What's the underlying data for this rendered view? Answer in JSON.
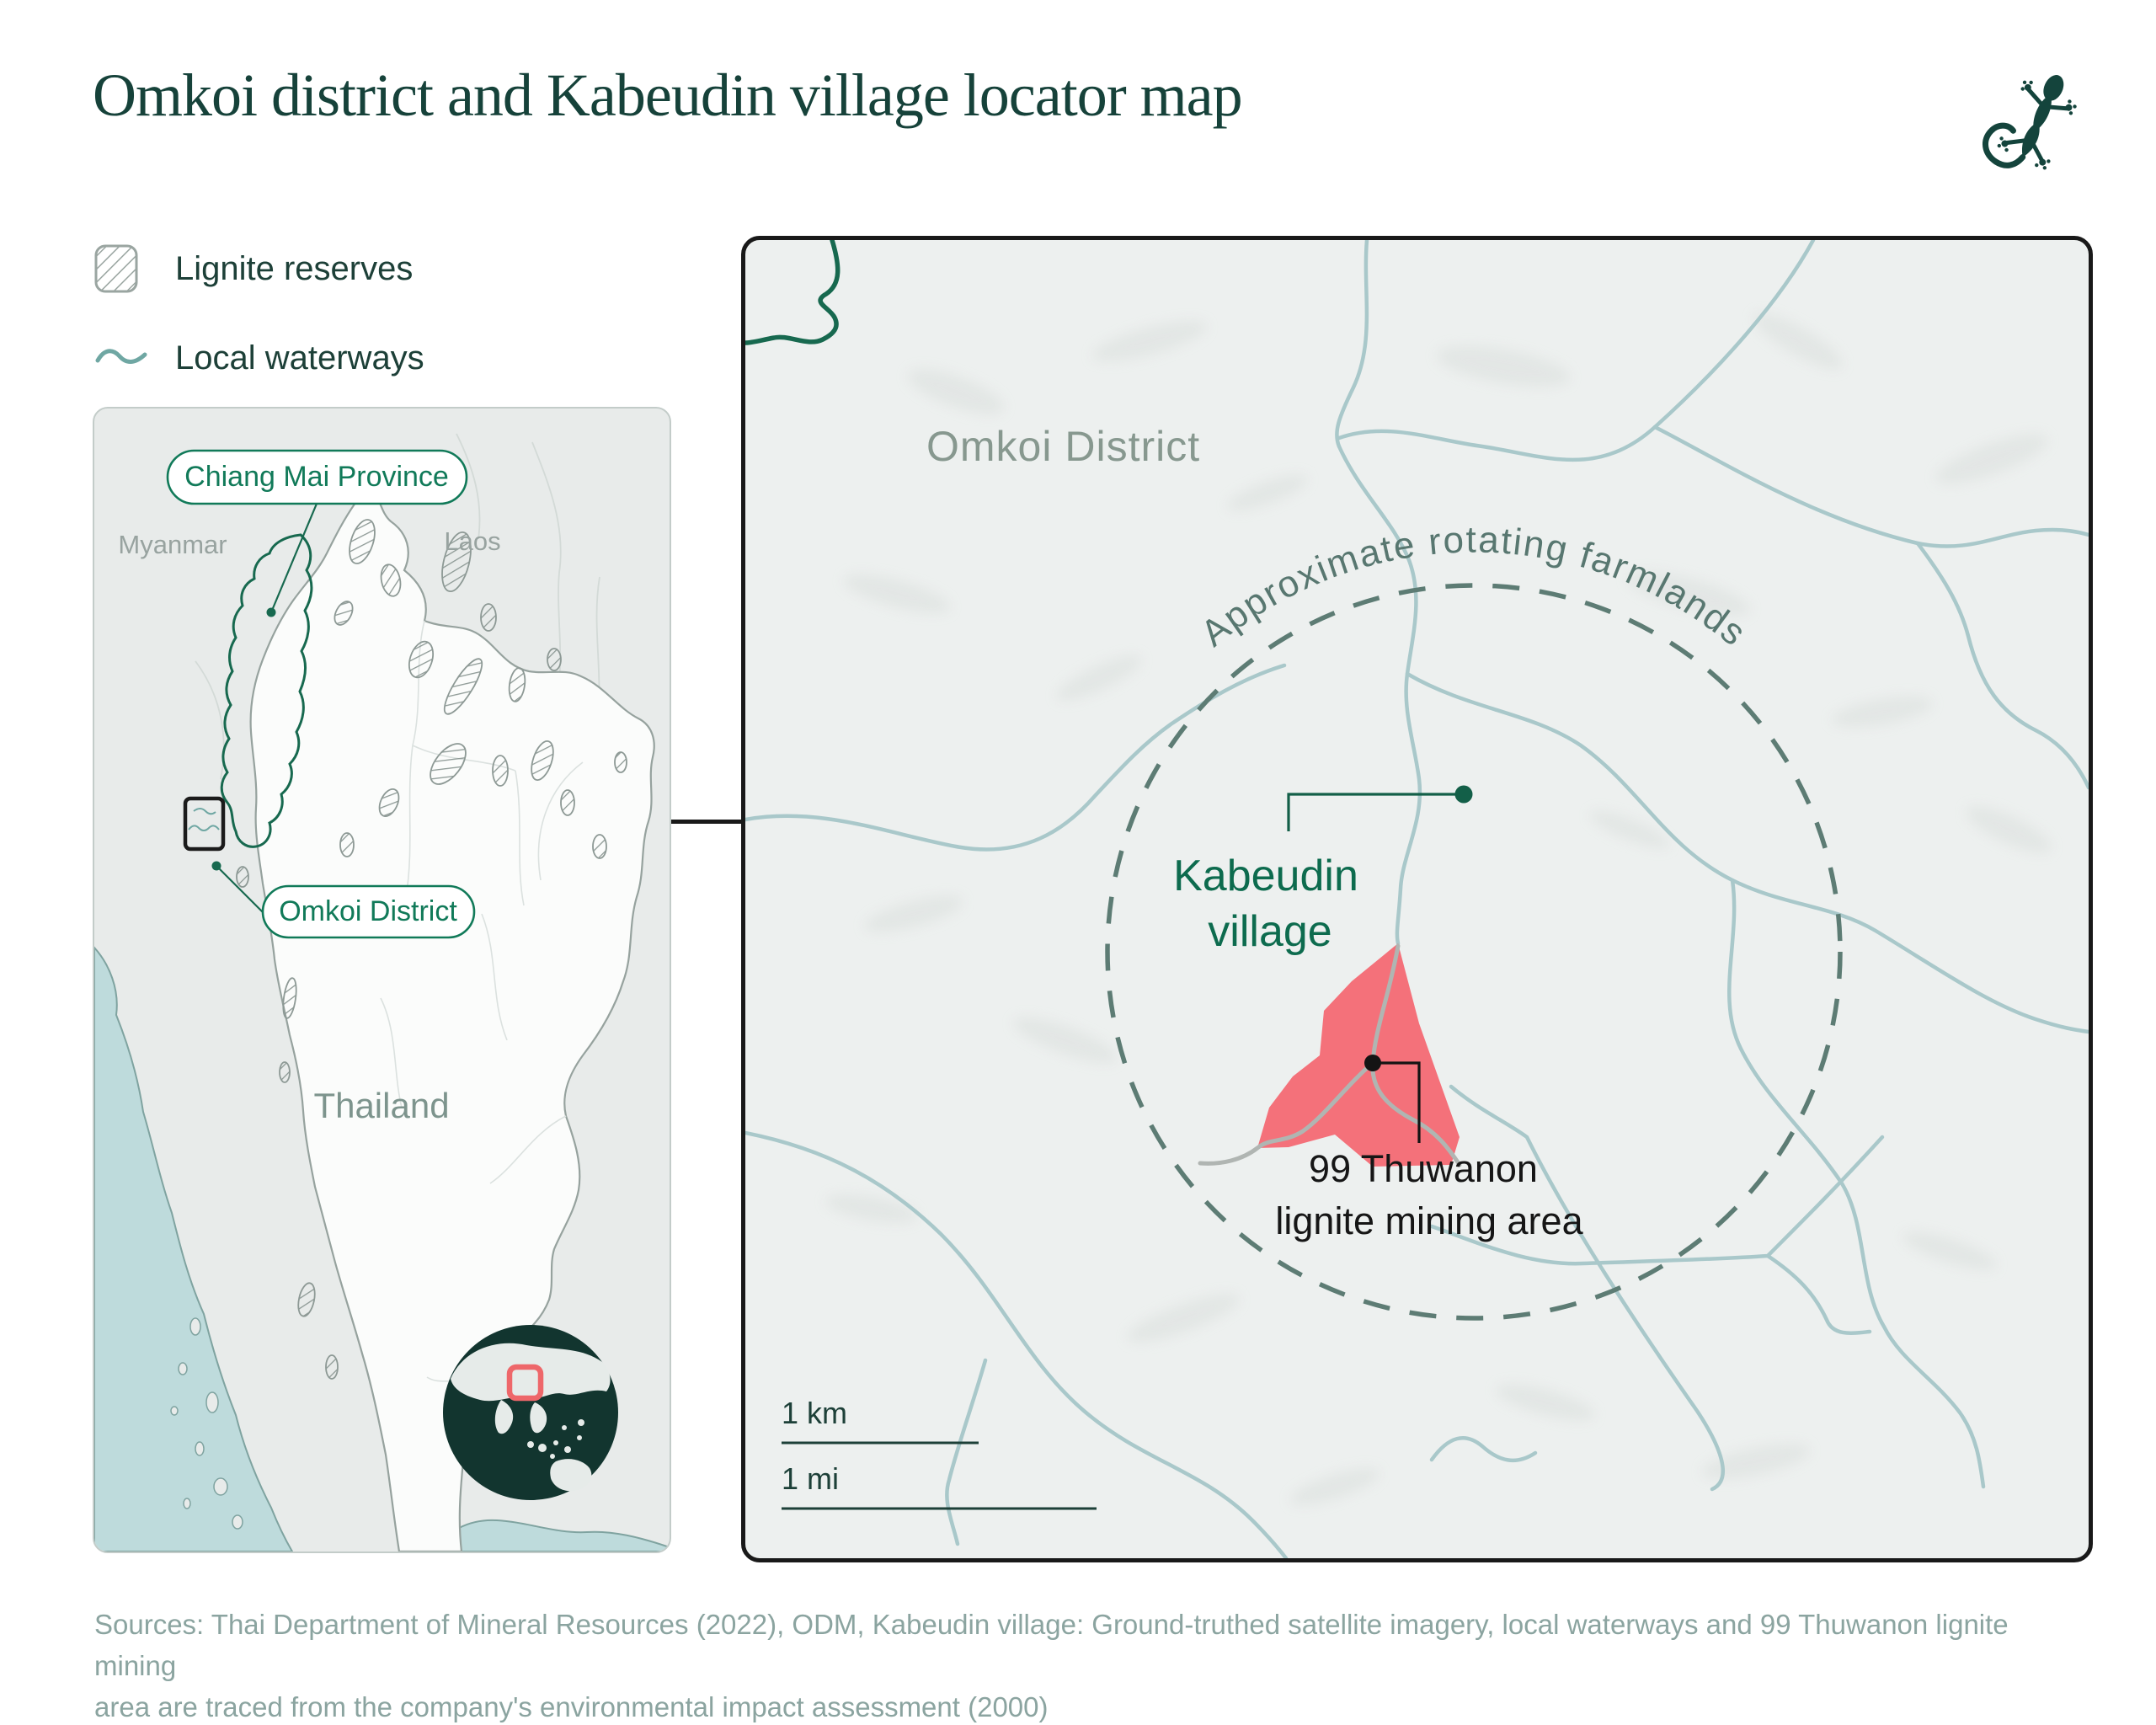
{
  "title": "Omkoi district and Kabeudin village locator map",
  "brand": {
    "logo_icon": "gecko-icon"
  },
  "legend": {
    "items": [
      {
        "label": "Lignite reserves",
        "swatch": "hatched-square"
      },
      {
        "label": "Local waterways",
        "swatch": "wavy-line"
      }
    ]
  },
  "overview_map": {
    "province_callout": "Chiang Mai Province",
    "district_callout": "Omkoi District",
    "myanmar_label": "Myanmar",
    "laos_label": "Laos",
    "thailand_label": "Thailand",
    "globe": {
      "highlight": "thailand-region",
      "highlight_color": "#ee676a"
    }
  },
  "detail_map": {
    "district_label": "Omkoi District",
    "farmlands_label": "Approximate rotating farmlands",
    "village_label_line1": "Kabeudin",
    "village_label_line2": "village",
    "mine_label_line1": "99 Thuwanon",
    "mine_label_line2": "lignite mining area",
    "scale_km_label": "1 km",
    "scale_mi_label": "1 mi"
  },
  "sources_line1": "Sources: Thai Department of Mineral Resources (2022), ODM, Kabeudin village: Ground-truthed satellite imagery, local waterways and 99 Thuwanon lignite mining",
  "sources_line2": "area are traced from the company's environmental impact assessment (2000)",
  "colors": {
    "title_green": "#16423a",
    "accent_green": "#117a59",
    "dark_green_line": "#17694f",
    "village_green": "#0d6b4e",
    "waterway_blue": "#a9c8ca",
    "legend_wave_teal": "#6fa7a3",
    "sea_blue": "#bedbdc",
    "mine_red": "#f4717a",
    "globe_marker_red": "#ee676a",
    "dashed_circle": "#5d7c74",
    "gray_label": "#87988f",
    "country_gray": "#98a3a0",
    "sources_gray": "#8ba4a0",
    "land_gray": "#e8ebea",
    "map_bg": "#edf0ef"
  }
}
